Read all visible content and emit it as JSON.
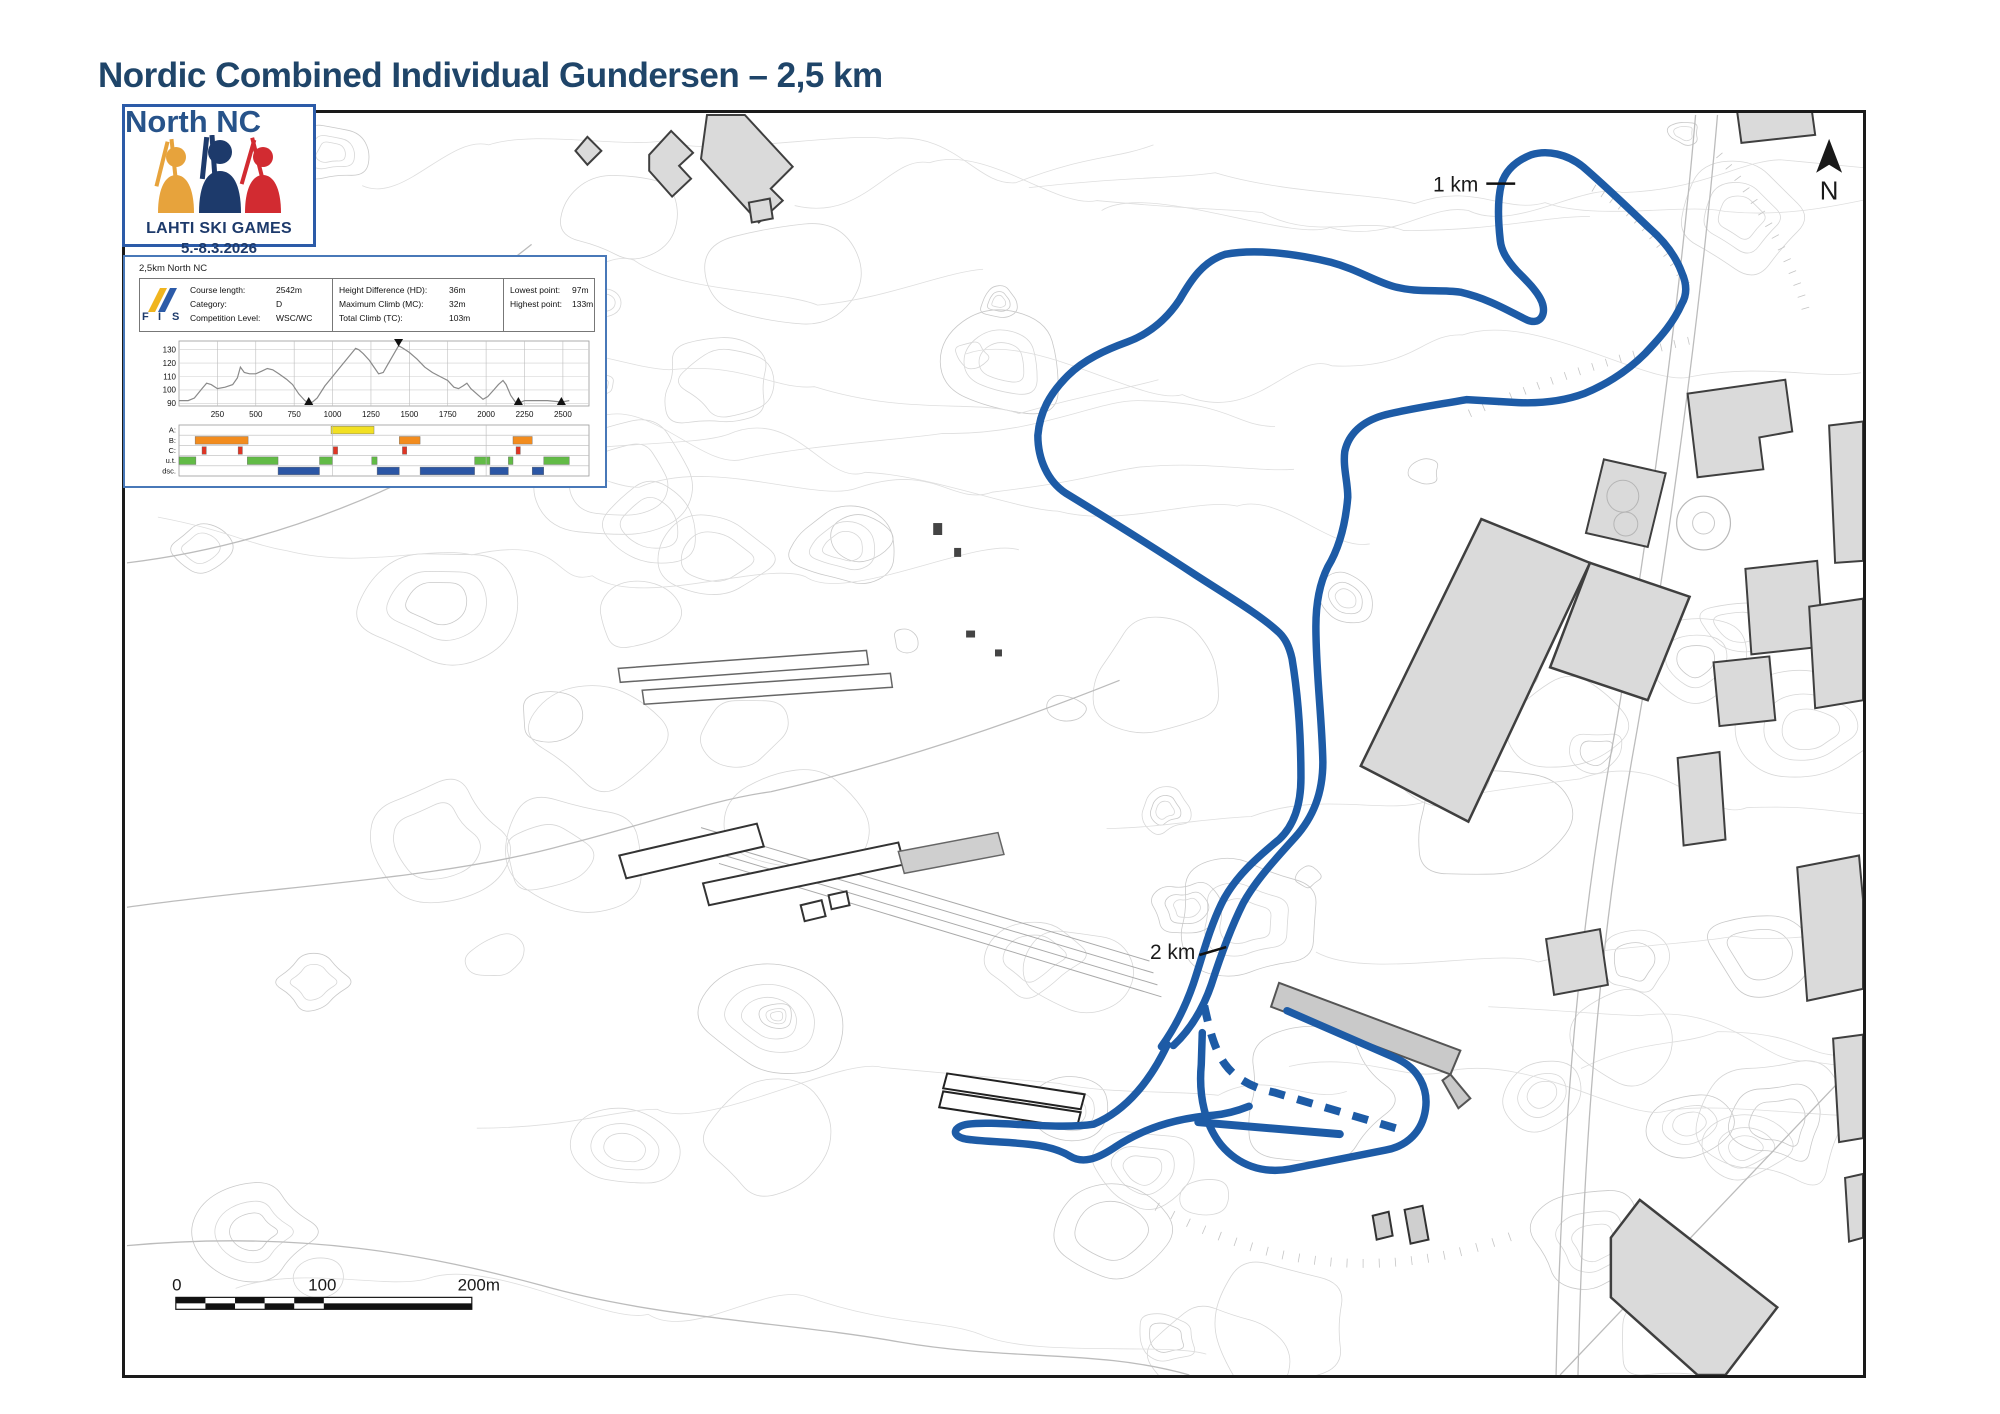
{
  "title": "Nordic Combined Individual Gundersen – 2,5 km",
  "overlay_text": "North NC",
  "logo": {
    "line1": "LAHTI SKI GAMES",
    "line2": "5.-8.3.2026"
  },
  "course_info": {
    "heading": "2,5km North NC",
    "fis_label": "FIS",
    "columns": [
      {
        "rows": [
          {
            "label": "Course length:",
            "value": "2542m"
          },
          {
            "label": "Category:",
            "value": "D"
          },
          {
            "label": "Competition Level:",
            "value": "WSC/WC"
          }
        ]
      },
      {
        "rows": [
          {
            "label": "Height Difference (HD):",
            "value": "36m"
          },
          {
            "label": "Maximum Climb (MC):",
            "value": "32m"
          },
          {
            "label": "Total Climb (TC):",
            "value": "103m"
          }
        ]
      },
      {
        "rows": [
          {
            "label": "Lowest point:",
            "value": "97m"
          },
          {
            "label": "Highest point:",
            "value": "133m"
          }
        ]
      }
    ]
  },
  "chart_data": {
    "type": "line",
    "title": "2,5km North NC course profile",
    "xlabel": "distance (m)",
    "ylabel": "elevation (m)",
    "xlim": [
      0,
      2670
    ],
    "ylim": [
      88,
      135
    ],
    "xticks": [
      250,
      500,
      750,
      1000,
      1250,
      1500,
      1750,
      2000,
      2250,
      2500
    ],
    "yticks": [
      90,
      100,
      110,
      120,
      130
    ],
    "grid": true,
    "profile": [
      [
        0,
        92
      ],
      [
        60,
        92
      ],
      [
        100,
        94
      ],
      [
        150,
        101
      ],
      [
        180,
        105
      ],
      [
        210,
        104
      ],
      [
        250,
        101
      ],
      [
        300,
        102
      ],
      [
        350,
        104
      ],
      [
        380,
        109
      ],
      [
        400,
        117
      ],
      [
        425,
        113
      ],
      [
        460,
        112
      ],
      [
        500,
        112
      ],
      [
        540,
        114
      ],
      [
        575,
        116
      ],
      [
        610,
        115
      ],
      [
        650,
        112
      ],
      [
        700,
        108
      ],
      [
        740,
        104
      ],
      [
        780,
        97
      ],
      [
        820,
        92
      ],
      [
        845,
        90
      ],
      [
        870,
        91
      ],
      [
        900,
        94
      ],
      [
        950,
        103
      ],
      [
        1000,
        110
      ],
      [
        1050,
        117
      ],
      [
        1100,
        124
      ],
      [
        1150,
        131
      ],
      [
        1170,
        130
      ],
      [
        1200,
        127
      ],
      [
        1240,
        122
      ],
      [
        1270,
        117
      ],
      [
        1300,
        112
      ],
      [
        1330,
        113
      ],
      [
        1360,
        119
      ],
      [
        1400,
        127
      ],
      [
        1430,
        133
      ],
      [
        1460,
        131
      ],
      [
        1500,
        128
      ],
      [
        1550,
        123
      ],
      [
        1600,
        117
      ],
      [
        1650,
        113
      ],
      [
        1700,
        110
      ],
      [
        1750,
        107
      ],
      [
        1790,
        102
      ],
      [
        1820,
        101
      ],
      [
        1850,
        103
      ],
      [
        1875,
        105
      ],
      [
        1900,
        101
      ],
      [
        1950,
        96
      ],
      [
        1980,
        93
      ],
      [
        2010,
        95
      ],
      [
        2050,
        100
      ],
      [
        2080,
        104
      ],
      [
        2110,
        107
      ],
      [
        2130,
        104
      ],
      [
        2160,
        96
      ],
      [
        2190,
        91
      ],
      [
        2210,
        90
      ],
      [
        2250,
        92
      ],
      [
        2300,
        92
      ],
      [
        2400,
        92
      ],
      [
        2490,
        91
      ],
      [
        2542,
        92
      ]
    ],
    "markers": {
      "lowest": [
        845,
        2210,
        2490
      ],
      "highest": [
        1430
      ]
    },
    "bands": {
      "row_labels": [
        "A:",
        "B:",
        "C:",
        "u.t.",
        "dsc."
      ],
      "A": [
        [
          990,
          1270
        ]
      ],
      "B": [
        [
          105,
          450
        ],
        [
          1435,
          1570
        ],
        [
          2175,
          2300
        ]
      ],
      "C": [
        [
          150,
          178
        ],
        [
          385,
          413
        ],
        [
          1005,
          1033
        ],
        [
          1455,
          1483
        ],
        [
          2195,
          2223
        ]
      ],
      "ut": [
        [
          0,
          110
        ],
        [
          445,
          645
        ],
        [
          915,
          1000
        ],
        [
          1255,
          1290
        ],
        [
          1925,
          2025
        ],
        [
          2145,
          2175
        ],
        [
          2375,
          2542
        ]
      ],
      "dsc": [
        [
          645,
          915
        ],
        [
          1290,
          1435
        ],
        [
          1570,
          1925
        ],
        [
          2025,
          2145
        ],
        [
          2300,
          2375
        ]
      ]
    }
  },
  "map": {
    "labels": {
      "km1": "1 km",
      "km2": "2 km",
      "north": "N"
    },
    "scalebar": {
      "t0": "0",
      "t100": "100",
      "t200": "200m"
    }
  },
  "colors": {
    "course": "#1d5ba6",
    "contour": "#d7d7d7",
    "road": "#bcbcbc",
    "building_fill": "#dadada",
    "building_stroke": "#3f3f3f",
    "profile_line": "#8a8a8a",
    "A": "#f2e023",
    "B": "#f28c1e",
    "C": "#e03524",
    "ut": "#62bb46",
    "dsc": "#2b56a5",
    "title_navy": "#1f4569",
    "logo_yellow": "#e7a33c",
    "logo_navy": "#1d3a6b",
    "logo_red": "#d22b31"
  }
}
